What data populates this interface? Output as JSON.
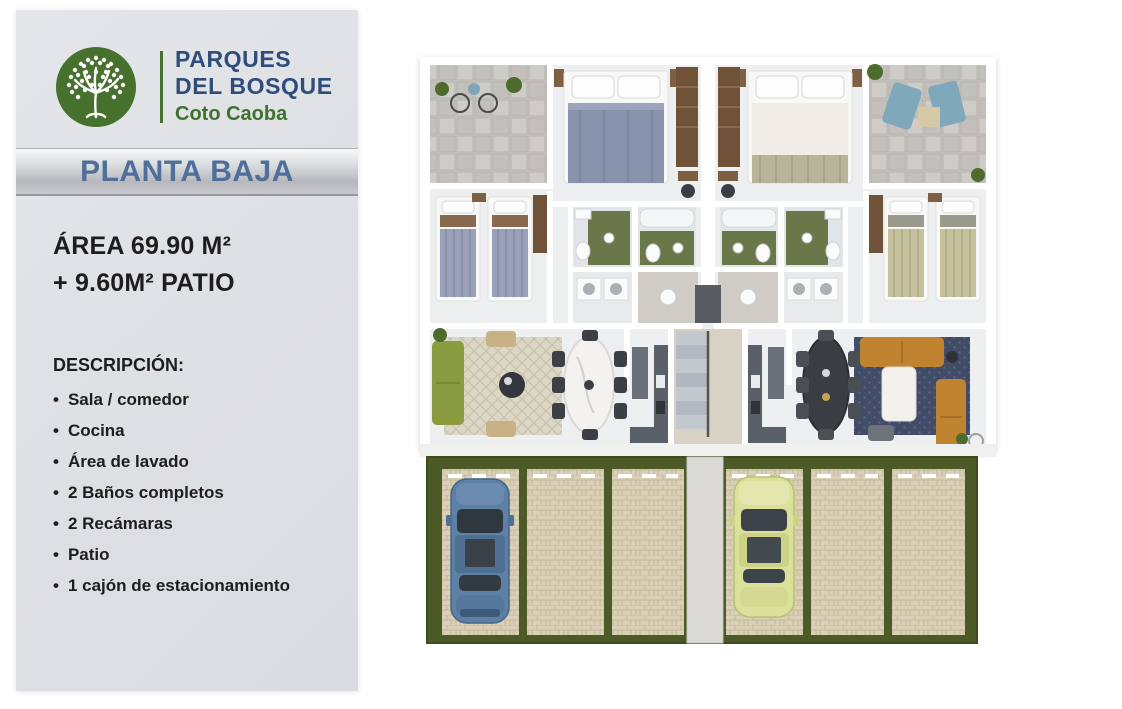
{
  "brand": {
    "line1": "PARQUES",
    "line2": "DEL BOSQUE",
    "subtitle": "Coto Caoba"
  },
  "plan": {
    "title": "PLANTA BAJA"
  },
  "area": {
    "line1": "ÁREA 69.90 M²",
    "line2": "+ 9.60M² PATIO"
  },
  "description": {
    "label": "DESCRIPCIÓN:",
    "items": [
      "Sala / comedor",
      "Cocina",
      "Área de lavado",
      "2 Baños completos",
      "2 Recámaras",
      "Patio",
      "1 cajón de estacionamiento"
    ]
  },
  "floorplan": {
    "type": "architectural-top-view",
    "units": 2,
    "parking_stalls": 6,
    "cars": [
      {
        "name": "blue-car",
        "color": "#5d80a5",
        "stall": 1
      },
      {
        "name": "yellow-green-car",
        "color": "#dbe09b",
        "stall": 4
      }
    ]
  },
  "colors": {
    "brand_blue": "#2e4d7a",
    "brand_green": "#3f7030",
    "logo_green": "#47722d",
    "banner_text": "#4d6f99",
    "card_bg": "#dfe1e4",
    "grass": "#4b5a26",
    "pavers": "#d9d0b7",
    "floor": "#edeff1",
    "bath_green": "#6a7849",
    "sofa_green": "#8b9b40",
    "sofa_amber": "#c08430",
    "rug_navy": "#414d68"
  }
}
